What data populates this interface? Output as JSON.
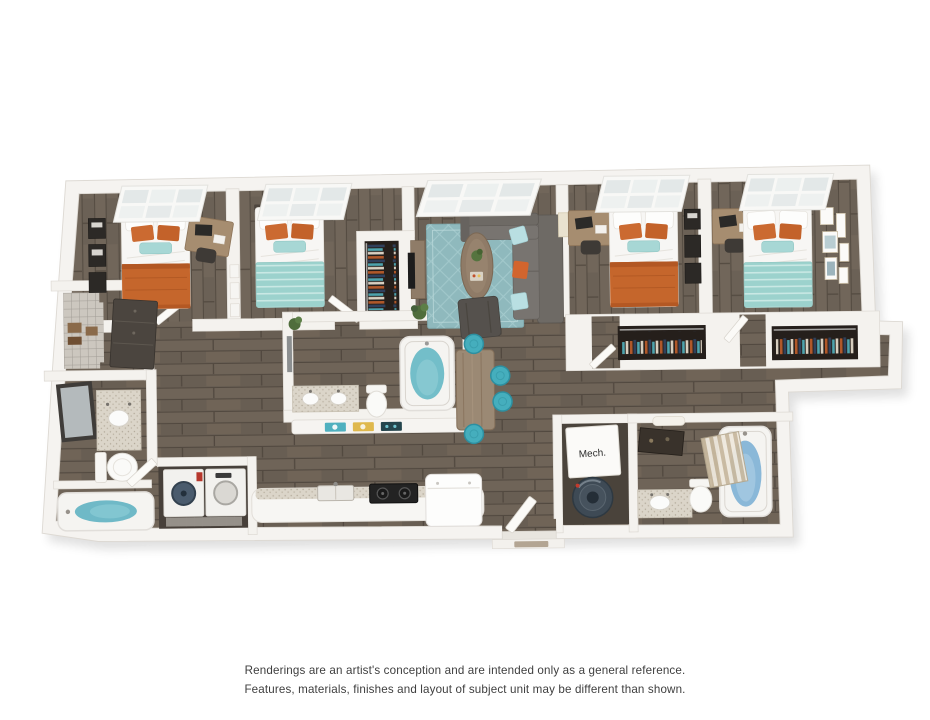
{
  "labels": {
    "mech_room": "Mech."
  },
  "disclaimer": {
    "line1": "Renderings are an artist's conception and are intended only as a general reference.",
    "line2": "Features, materials, finishes and layout of subject unit may be different than shown."
  },
  "colors": {
    "background": "#ffffff",
    "walls": "#f4f2ee",
    "floor_wood": "#6b6156",
    "accent_orange": "#c5662c",
    "accent_teal": "#9dd2cd",
    "rug_teal": "#8fb9bd",
    "sofa_gray": "#6e6a65",
    "stool_teal": "#45aebd",
    "bath_water_teal": "#73bec9",
    "bath_water_blue": "#8ab8d8",
    "disclaimer_text": "#3e3e3e"
  }
}
